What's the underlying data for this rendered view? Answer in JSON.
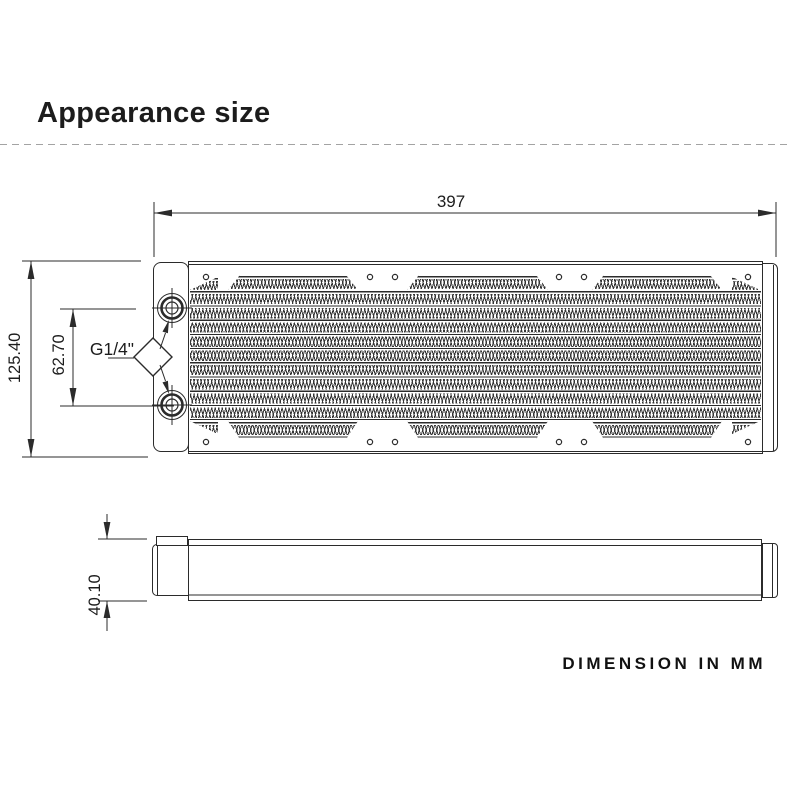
{
  "header": {
    "title": "Appearance size"
  },
  "labels": {
    "length": "397",
    "overall_height": "125.40",
    "port_spacing": "62.70",
    "port_thread": "G1/4\"",
    "thickness": "40.10"
  },
  "footer": {
    "note": "DIMENSION IN MM"
  },
  "colors": {
    "line": "#2b2b2b",
    "text": "#1c1c1c"
  }
}
